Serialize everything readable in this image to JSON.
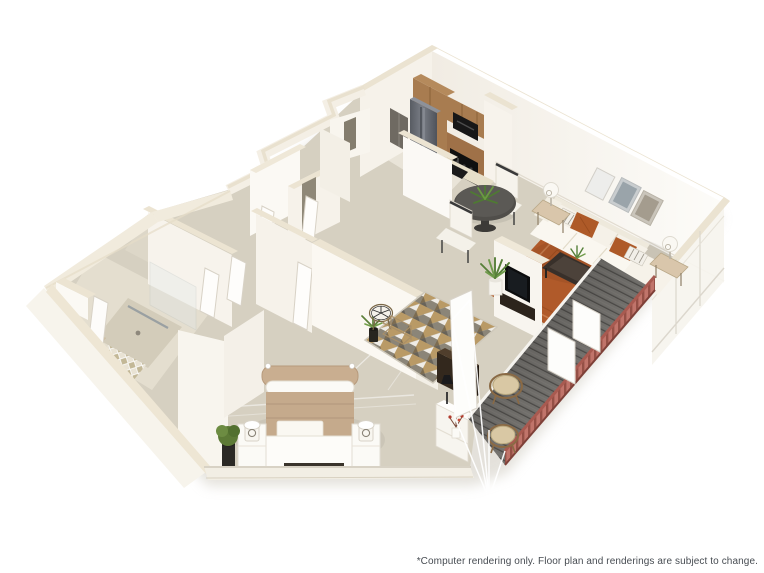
{
  "page": {
    "background_color": "#ffffff",
    "width_px": 764,
    "height_px": 573
  },
  "disclaimer": {
    "text": "*Computer rendering only. Floor plan and renderings are subject to change.",
    "color": "#474c52"
  },
  "floorplan": {
    "kind": "3D axonometric rendering of a one-bedroom apartment",
    "rooms": [
      "kitchen",
      "dining area",
      "living room",
      "entry",
      "hallway",
      "bedroom",
      "bathroom",
      "walk-in closet",
      "balcony"
    ],
    "furnishings": [
      "refrigerator",
      "range",
      "microwave",
      "kitchen cabinets",
      "peninsula counter with sink",
      "round dining table with two chairs",
      "sofa with accent pillows",
      "coffee table",
      "area rug",
      "three framed wall art pieces",
      "two table lamps",
      "wall TV",
      "media chest",
      "white console table",
      "accent chair",
      "wire shelf",
      "triangle-pattern entry rug",
      "bed",
      "two nightstands with lamps",
      "potted plants",
      "glass shower",
      "closet doors",
      "two round patio chairs",
      "plank deck with railing"
    ],
    "colors": {
      "wall_face": "#f8f5ef",
      "wall_shade": "#ece6db",
      "wall_top": "#ebe3d1",
      "carpet": "#d6d0c1",
      "tile": "#e9e4d8",
      "cabinet_wood": "#a87c50",
      "stainless": "#666a72",
      "appliance_black": "#141414",
      "counter": "#e7dfc9",
      "dining_table": "#504e4a",
      "sofa": "#f5f1e8",
      "accent_pillow": "#ae5a28",
      "rug_rust": "#b05a2a",
      "bed_comforter": "#c5aa8c",
      "deck": "#75736f",
      "railing": "#c0746a",
      "plant_green": "#5d8139",
      "rug_triangle_tan": "#b99a66",
      "rug_triangle_gray": "#8b8578"
    }
  }
}
